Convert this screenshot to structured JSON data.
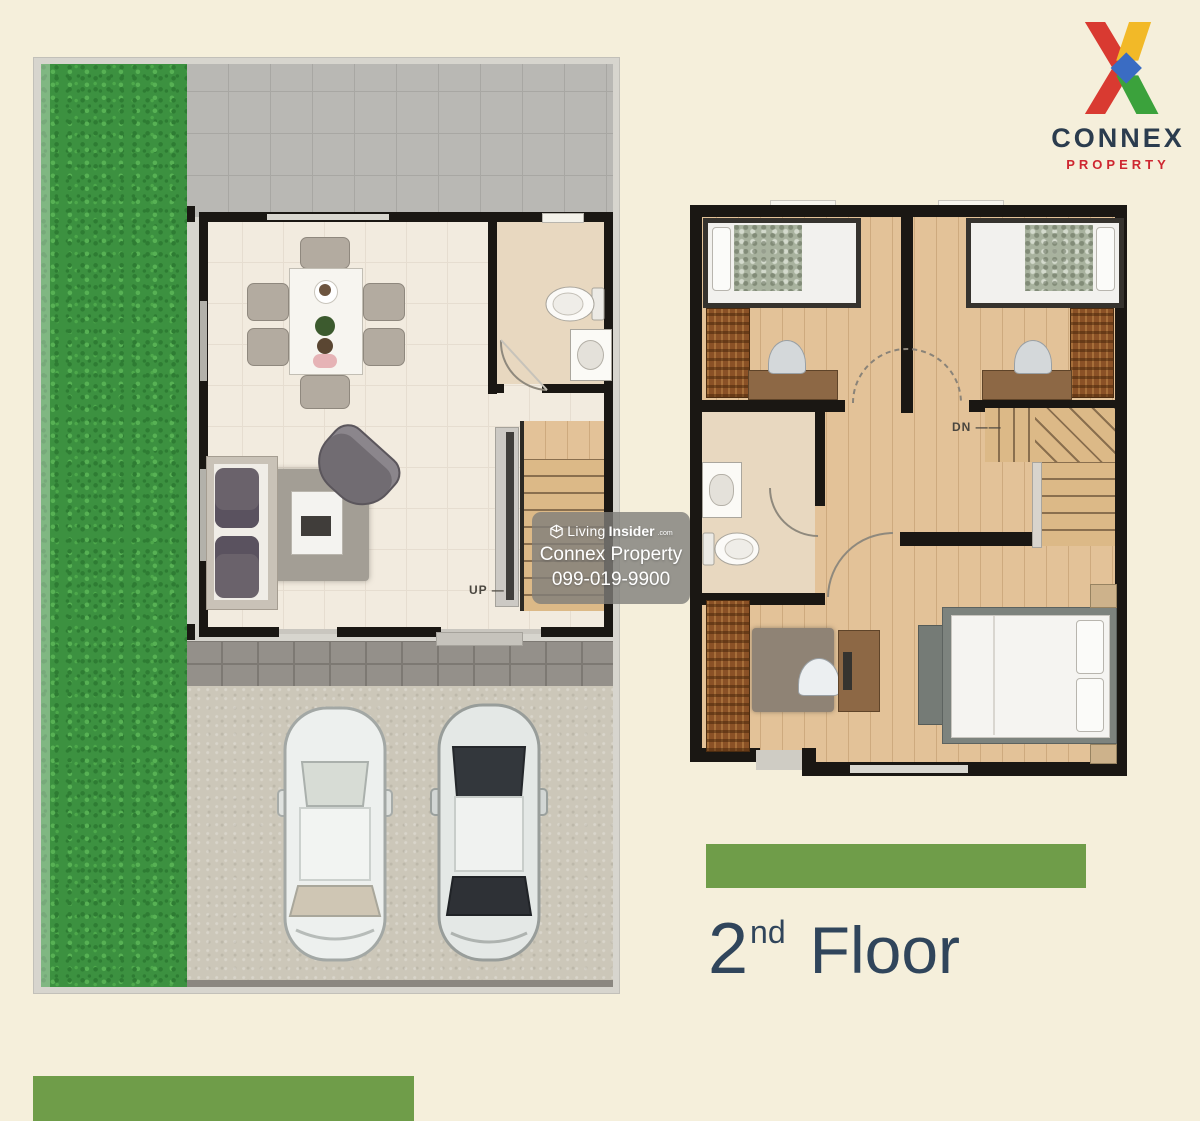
{
  "canvas": {
    "width": 1200,
    "height": 1121,
    "background": "#f5efdb"
  },
  "brand": {
    "name": "CONNEX",
    "tagline": "PROPERTY",
    "name_color": "#2b3c4e",
    "tagline_color": "#ce2630",
    "x_icon_colors": {
      "red": "#d93a31",
      "yellow": "#f2b928",
      "blue": "#3a6cc3",
      "green": "#3ba23c"
    }
  },
  "watermark": {
    "site_prefix": "Living",
    "site_bold": "Insider",
    "site_suffix": ".com",
    "company": "Connex Property",
    "phone": "099-019-9900"
  },
  "floor_label": {
    "number": "2",
    "ordinal": "nd",
    "word": "Floor",
    "color": "#30455b"
  },
  "bars": {
    "color": "#6f9d49"
  },
  "first_floor": {
    "stairs_label": "UP"
  },
  "second_floor": {
    "stairs_label": "DN"
  }
}
